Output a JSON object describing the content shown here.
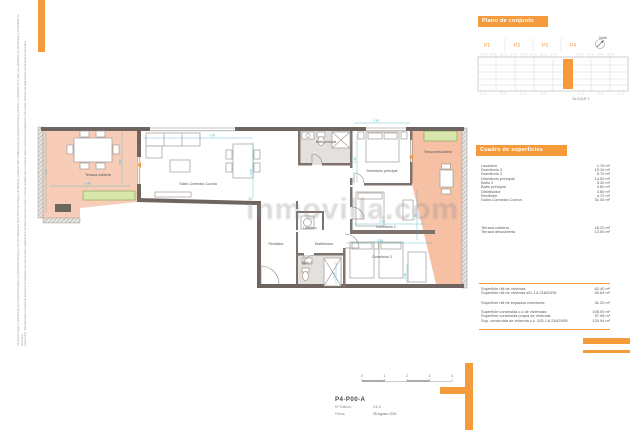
{
  "site_panel": {
    "title": "Plano de conjunto",
    "units": [
      "P1",
      "P2",
      "P3",
      "P4"
    ],
    "north_label": "Norte",
    "block_label": "BLOQUE 1"
  },
  "surfaces_panel": {
    "title": "Cuadro de superficies",
    "rooms": [
      {
        "label": "Lavadero",
        "value": "1.10 m²"
      },
      {
        "label": "Dormitorio 3",
        "value": "10.10 m²"
      },
      {
        "label": "Dormitorio 2",
        "value": "9.70 m²"
      },
      {
        "label": "Dormitorio principal",
        "value": "14.50 m²"
      },
      {
        "label": "Baño 2",
        "value": "3.30 m²"
      },
      {
        "label": "Baño principal",
        "value": "3.80 m²"
      },
      {
        "label": "Distribuidor",
        "value": "3.80 m²"
      },
      {
        "label": "Recibidor",
        "value": "4.70 m²"
      },
      {
        "label": "Salón-Comedor-Cocina",
        "value": "31.40 m²"
      }
    ],
    "terraces": [
      {
        "label": "Terraza cubierta",
        "value": "18.20 m²"
      },
      {
        "label": "Terraza descubierta",
        "value": "13.00 m²"
      }
    ],
    "totals": [
      {
        "label": "Superficie útil de vivienda:",
        "value": "82.40 m²"
      },
      {
        "label": "Superficie útil de vivienda s/D.J.A 218/2005:",
        "value": "90.64 m²"
      },
      {
        "label": "Superficie útil de espacios exteriores:",
        "value": "31.20 m²"
      },
      {
        "label": "Superficie construida c.c de viviendas:",
        "value": "108.00 m²"
      },
      {
        "label": "Superficie construida propia de vivienda:",
        "value": "97.08 m²"
      },
      {
        "label": "Sup. construida de vivienda c.c. S/D.J.A 218/2005:",
        "value": "120.94 m²"
      }
    ]
  },
  "plan": {
    "rooms": {
      "terraza_cubierta": "Terraza cubierta",
      "salon": "Salón-Comedor-Cocina",
      "bano_principal": "Baño principal",
      "dormitorio_principal": "Dormitorio principal",
      "terraza_descubierta": "Terraza descubierta",
      "lavadero": "Lavadero",
      "recibidor": "Recibidor",
      "distribuidor": "Distribuidor",
      "bano_2": "Baño 2",
      "dormitorio_2": "Dormitorio 2",
      "dormitorio_3": "Dormitorio 3"
    },
    "dims": [
      "4.00",
      "4.45",
      "3.80",
      "7.95",
      "3.95",
      "3.28",
      "2.66",
      "3.95",
      "3.95",
      "2.95",
      "1.46",
      "7.36"
    ]
  },
  "title_block": {
    "code": "P4-P00-A",
    "edition_label": "Nº Edición:",
    "edition_value": "V.1.0",
    "date_label": "Fecha:",
    "date_value": "05 Agosto 2024",
    "scale_ticks": [
      "0",
      "1",
      "2",
      "3",
      "4"
    ]
  },
  "watermark": {
    "text": "inmovilla.com"
  },
  "disclaimer": {
    "line_es": "Advertencia legal: La información que contiene este plano es meramente orientativa y ha sido elaborada a partir del Proyecto Básico de Ejecución, pudiendo sufrir modificaciones por exigencias técnicas, jurídicas o comerciales de la obra. Las superficies son aproximadas y el mobiliario es decorativo.",
    "line_en": "Legal notice: The information contained in this plan is for guidance only and has been prepared from the Basic Execution Project; it may be modified due to technical, legal or commercial requirements of the works. Surfaces are approximate and furniture is decorative."
  },
  "colors": {
    "accent": "#F59B3C",
    "terrace_covered": "#F7CDB8",
    "terrace_open": "#F5C0A4",
    "wall": "#6F6560",
    "bath": "#E3E0DD",
    "planter": "#D8E6AB",
    "dimension": "#45B8C8"
  }
}
